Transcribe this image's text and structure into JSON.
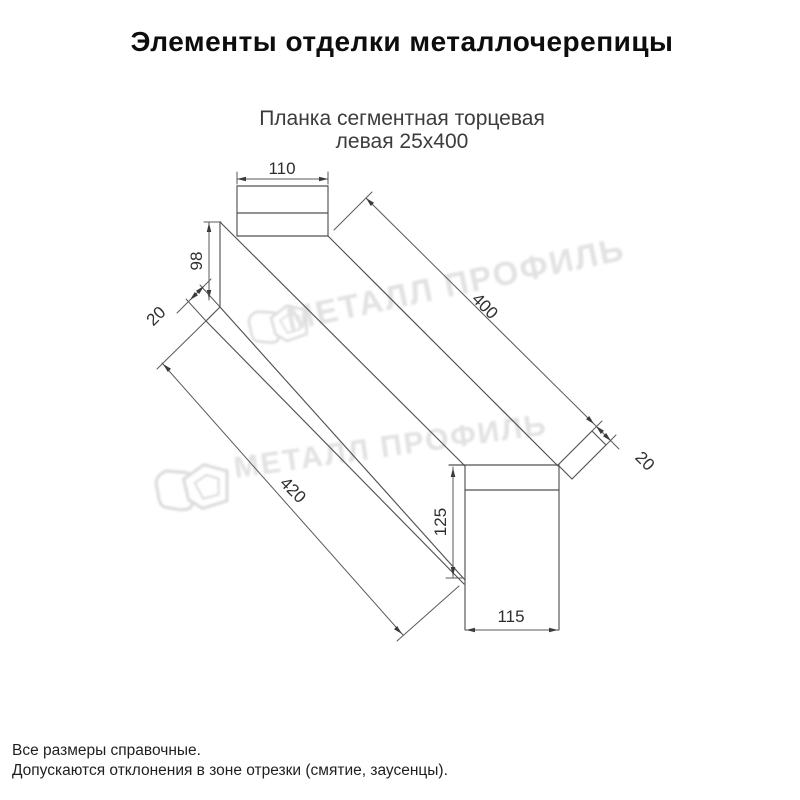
{
  "page": {
    "title": "Элементы отделки металлочерепицы",
    "subtitle_line1": "Планка сегментная торцевая",
    "subtitle_line2": "левая 25х400",
    "footer_note1": "Все размеры справочные.",
    "footer_note2": "Допускаются отклонения в зоне отрезки (смятие, заусенцы)."
  },
  "watermark": {
    "text": "МЕТАЛЛ ПРОФИЛЬ",
    "color": "#e3e3e3"
  },
  "drawing": {
    "product": "Планка сегментная торцевая левая 25х400",
    "line_color": "#525252",
    "dimensions": {
      "top_flange_width": "110",
      "top_end_height": "98",
      "top_hem": "20",
      "top_face_length": "400",
      "bottom_face_length": "420",
      "end_segment_height": "125",
      "end_segment_width": "115",
      "end_hem": "20"
    }
  }
}
